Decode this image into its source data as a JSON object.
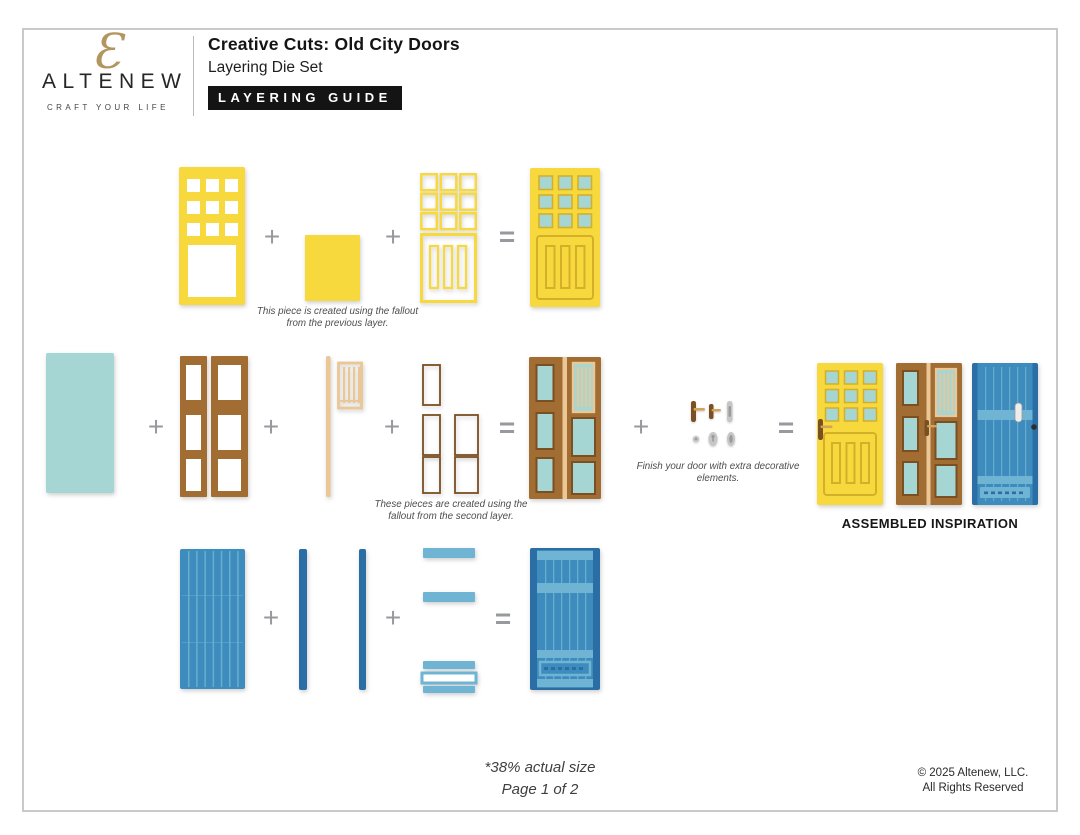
{
  "header": {
    "logo": {
      "word": "ALTENEW",
      "glyph": "Ɛ",
      "tagline": "CRAFT YOUR LIFE"
    },
    "title": "Creative Cuts: Old City Doors",
    "subtitle": "Layering Die Set",
    "badge": "LAYERING GUIDE"
  },
  "operators": {
    "plus": "+",
    "equals": "="
  },
  "captions": {
    "previous_layer": "This piece is created using the fallout from the previous layer.",
    "second_layer": "These pieces are created using the fallout from the second layer.",
    "decorative": "Finish your door with extra decorative elements."
  },
  "assembled_label": "ASSEMBLED INSPIRATION",
  "footer": {
    "scale_note": "*38% actual size",
    "page_note": "Page 1 of 2",
    "copyright_line1": "© 2025 Altenew, LLC.",
    "copyright_line2": "All Rights Reserved"
  },
  "colors": {
    "yellow": "#F7D93D",
    "yellow_dark": "#D4AF2A",
    "teal": "#A6D6D4",
    "brown": "#A26D33",
    "brown_dark": "#7A4F22",
    "tan": "#EAC795",
    "brass": "#D3A358",
    "blue_mid": "#3E8CBE",
    "blue_dark": "#2B6EA6",
    "blue_light": "#6FB4D2",
    "silver": "#C6C6C6",
    "silver_dark": "#9B9B9B",
    "operator_gray": "#97999E",
    "badge_black": "#141414",
    "logo_gold": "#B3955F",
    "page_border": "#C9C9C9",
    "text_dark": "#1A1A1A"
  }
}
